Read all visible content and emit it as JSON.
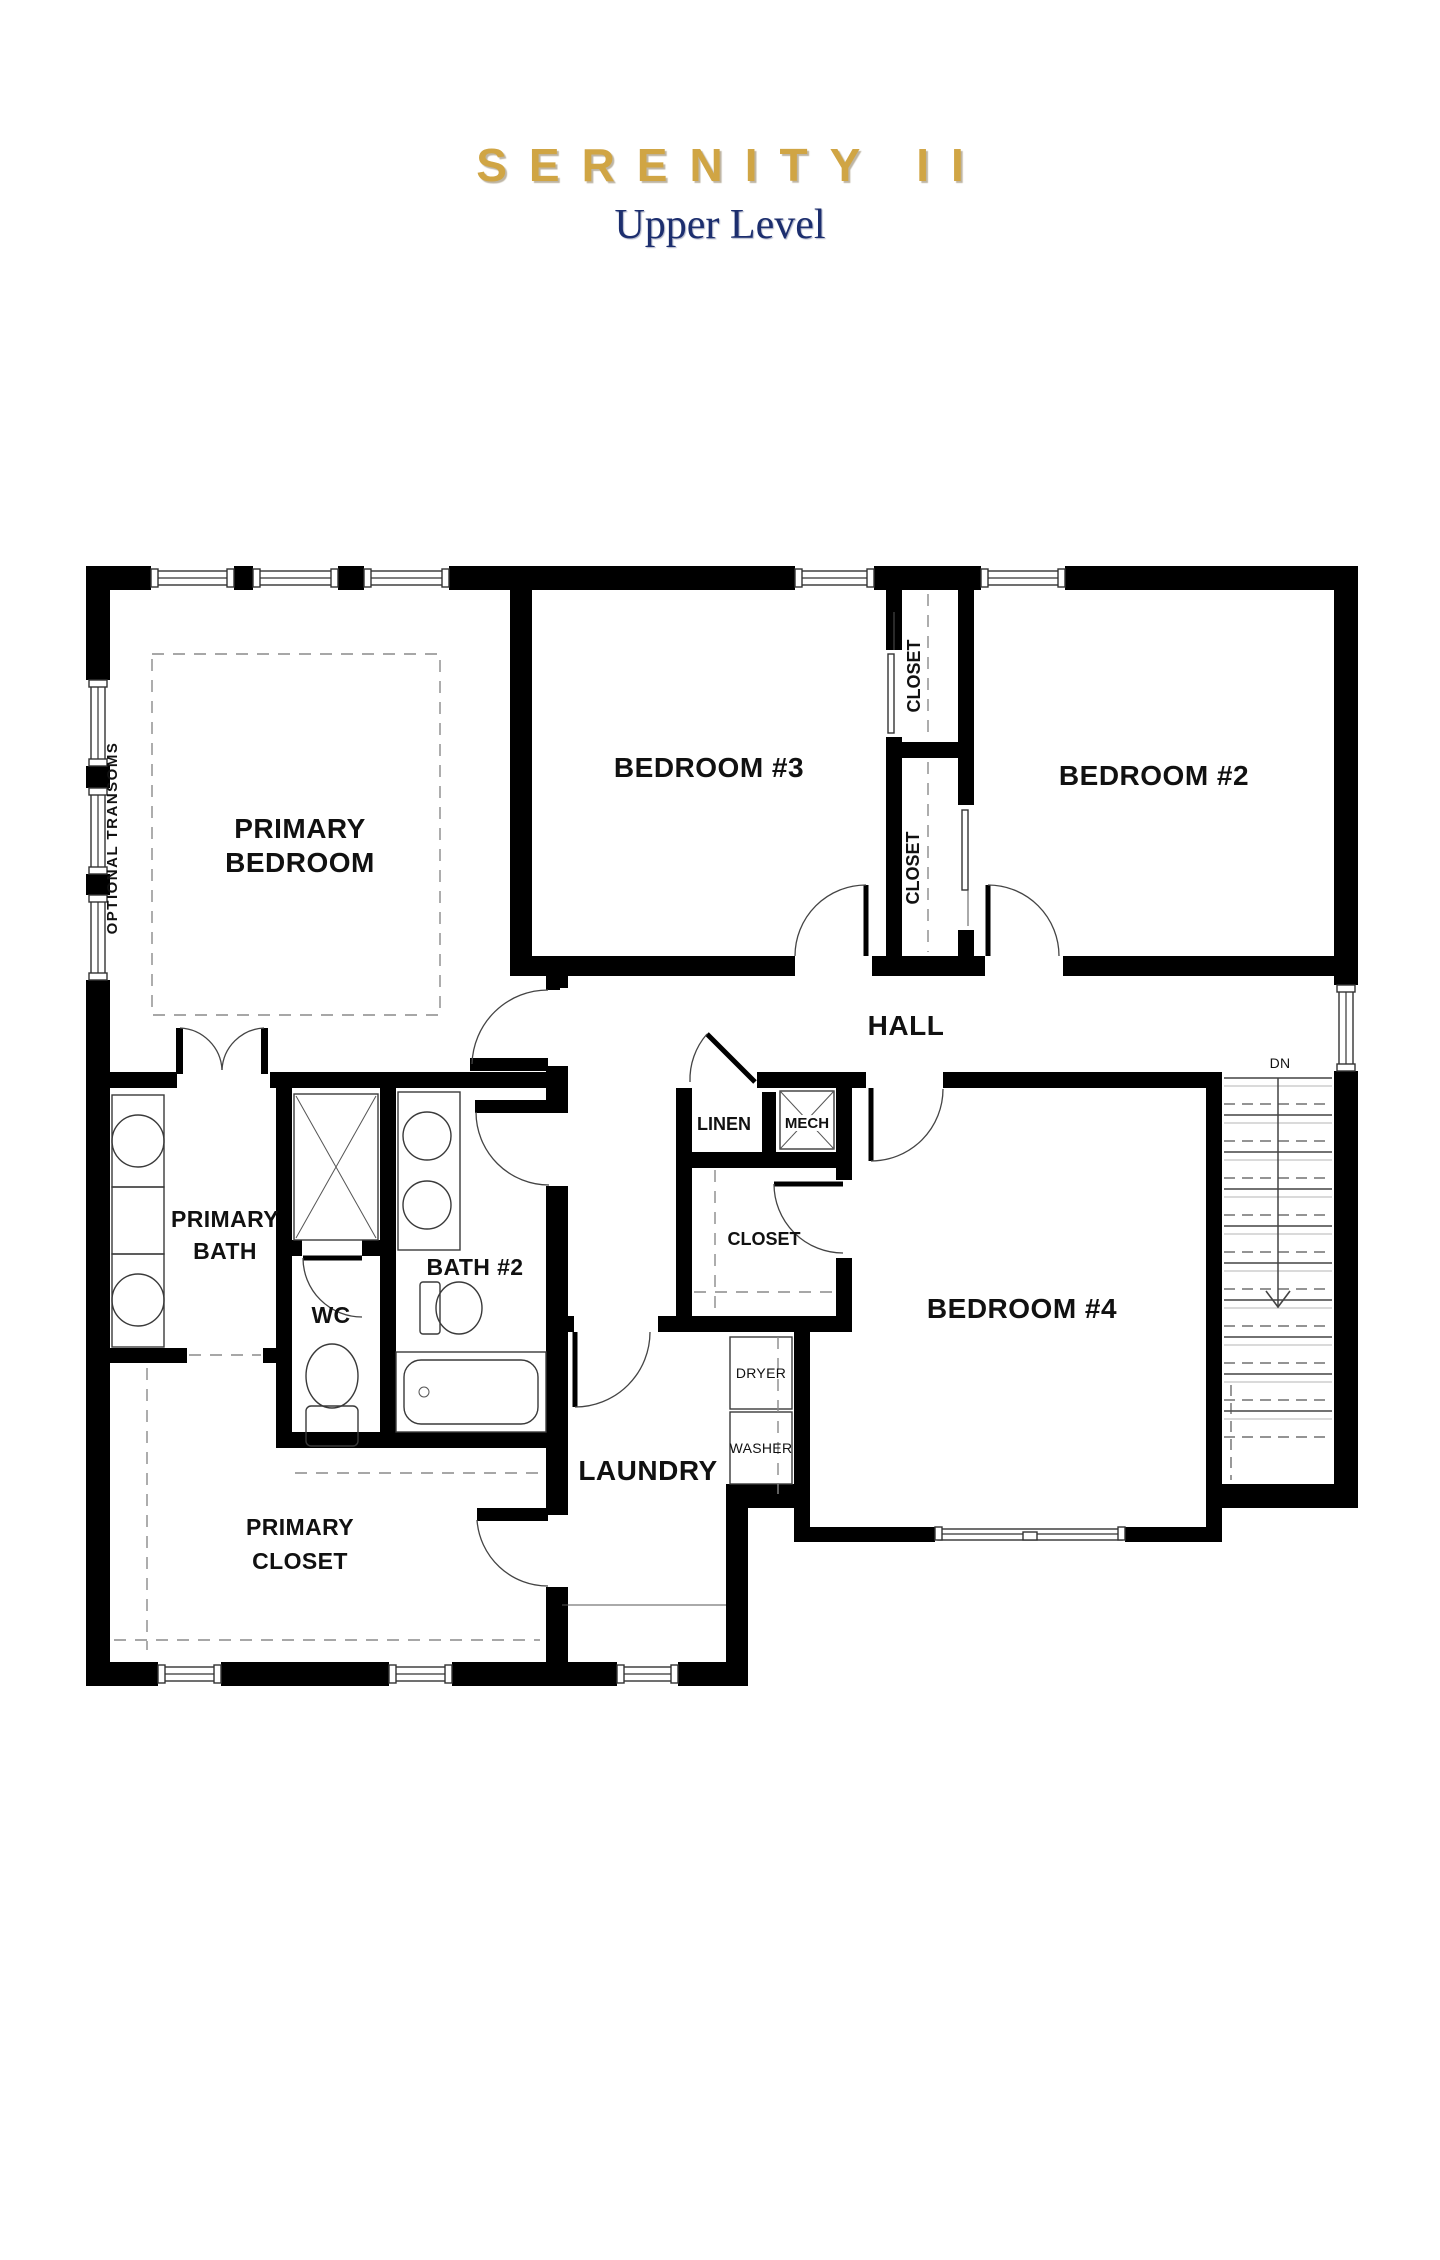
{
  "header": {
    "title": "SERENITY II",
    "subtitle": "Upper Level"
  },
  "colors": {
    "title_gold": "#d0a544",
    "subtitle_navy": "#1c2e6e",
    "walls_black": "#000000"
  },
  "plan": {
    "rooms": {
      "primary_bedroom": {
        "line1": "PRIMARY",
        "line2": "BEDROOM"
      },
      "bedroom_3": {
        "label": "BEDROOM #3"
      },
      "bedroom_2": {
        "label": "BEDROOM #2"
      },
      "bedroom_4": {
        "label": "BEDROOM #4"
      },
      "hall": {
        "label": "HALL"
      },
      "primary_bath": {
        "line1": "PRIMARY",
        "line2": "BATH"
      },
      "bath_2": {
        "label": "BATH #2"
      },
      "wc": {
        "label": "WC"
      },
      "laundry": {
        "label": "LAUNDRY"
      },
      "primary_closet": {
        "line1": "PRIMARY",
        "line2": "CLOSET"
      },
      "linen": {
        "label": "LINEN"
      },
      "mech": {
        "label": "MECH"
      },
      "closet_bedroom_3": {
        "label": "CLOSET"
      },
      "closet_bedroom_2": {
        "label": "CLOSET"
      },
      "closet_bedroom_4": {
        "label": "CLOSET"
      }
    },
    "appliances": {
      "dryer": "DRYER",
      "washer": "WASHER"
    },
    "stairs": {
      "direction_label": "DN"
    },
    "annotations": {
      "left_wall_note": "OPTIONAL TRANSOMS"
    }
  }
}
